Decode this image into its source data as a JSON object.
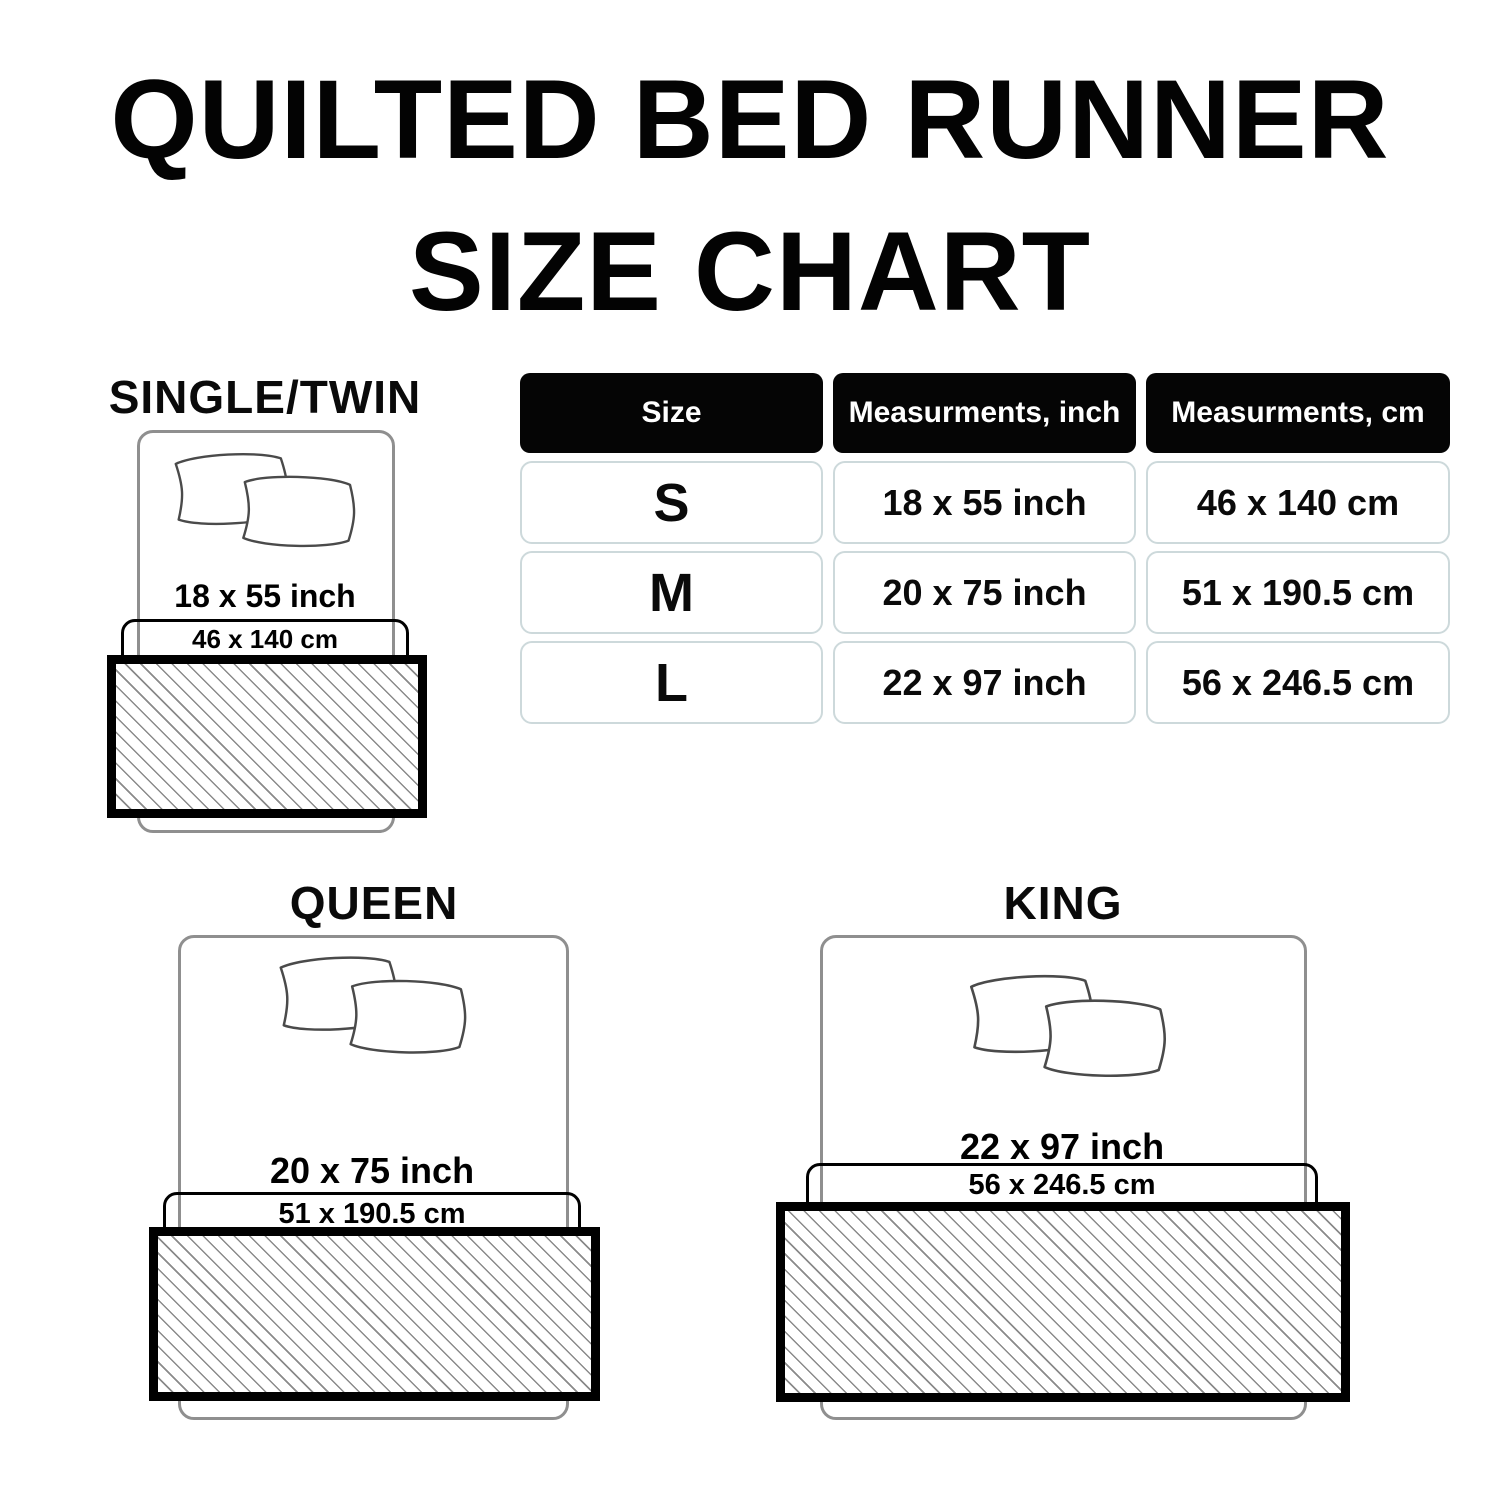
{
  "title": {
    "line1": "QUILTED BED RUNNER",
    "line2": "SIZE CHART"
  },
  "table": {
    "headers": [
      "Size",
      "Measurments, inch",
      "Measurments, cm"
    ],
    "rows": [
      {
        "size": "S",
        "inch": "18 x 55 inch",
        "cm": "46 x 140 cm"
      },
      {
        "size": "M",
        "inch": "20 x 75 inch",
        "cm": "51 x 190.5 cm"
      },
      {
        "size": "L",
        "inch": "22 x 97 inch",
        "cm": "56 x 246.5 cm"
      }
    ]
  },
  "diagrams": [
    {
      "label": "SINGLE/TWIN",
      "inch": "18 x 55 inch",
      "cm": "46 x 140 cm"
    },
    {
      "label": "QUEEN",
      "inch": "20 x 75 inch",
      "cm": "51 x 190.5 cm"
    },
    {
      "label": "KING",
      "inch": "22 x 97 inch",
      "cm": "56 x 246.5 cm"
    }
  ],
  "colors": {
    "title_text": "#030303",
    "header_bg": "#050505",
    "header_text": "#ffffff",
    "cell_border": "#cdd9db",
    "bed_outline": "#8f8f8f",
    "runner_border": "#000000",
    "hatch_line": "#8a8a8a"
  }
}
